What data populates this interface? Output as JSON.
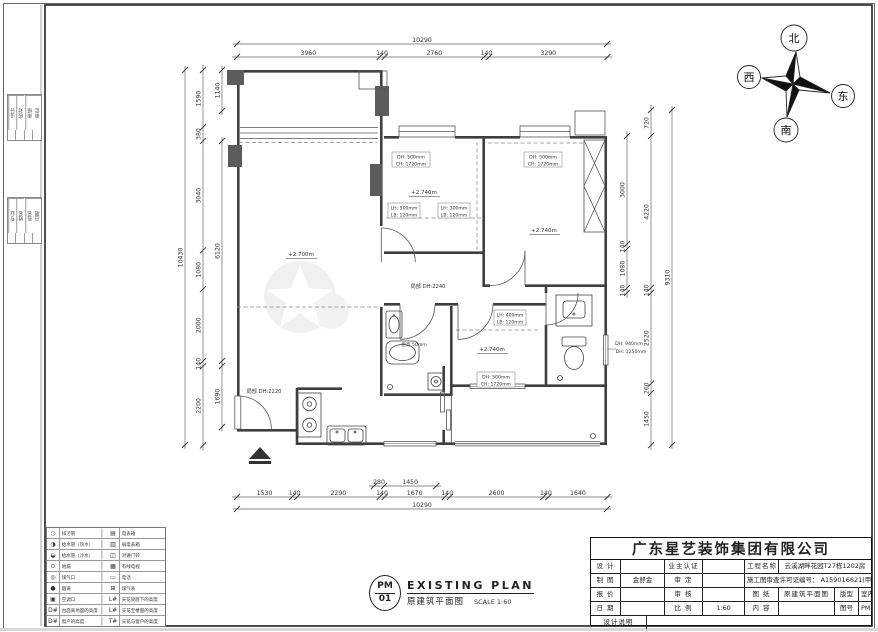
{
  "sheet": {
    "company": "广东星艺装饰集团有限公司",
    "title_en": "EXISTING PLAN",
    "title_cn": "原建筑平面图",
    "scale_label": "SCALE 1:60",
    "logo_top": "PM",
    "logo_bottom": "01"
  },
  "titleblock": {
    "design_label": "设 计",
    "draw_label": "制 图",
    "quote_label": "报 价",
    "date_label": "日 期",
    "note_label": "设计说明",
    "draw_value": "金舒金",
    "owner_label": "业主认证",
    "approve_label": "审 定",
    "check_label": "审 核",
    "ratio_label": "比 例",
    "ratio_value": "1:60",
    "project_label": "工程名称",
    "project_value": "云溪湖畔花园T27栋1202房",
    "permit_value": "施工图审查许可证编号： A159016621(甲级)",
    "paper_label": "图 纸",
    "content_label": "内 容",
    "paper_value": "原建筑平面图",
    "type_label": "版型",
    "type_value": "室内施工图",
    "no_label": "图号",
    "no_value": "PM-01"
  },
  "compass": {
    "north": "北",
    "south": "南",
    "east": "东",
    "west": "西"
  },
  "dims": {
    "top": {
      "total": "10290",
      "segs": [
        "3960",
        "140",
        "2760",
        "140",
        "3290"
      ]
    },
    "bottom": {
      "total": "10290",
      "segs": [
        "1530",
        "140",
        "2290",
        "140",
        "1670",
        "140",
        "2600",
        "140",
        "1640"
      ],
      "inner": [
        "280",
        "1450"
      ]
    },
    "left": {
      "total": "10430",
      "segs": [
        "1590",
        "380",
        "3040",
        "1080",
        "2000",
        "140",
        "2200"
      ],
      "inner": [
        "1140",
        "6120",
        "1690"
      ]
    },
    "right": {
      "total": "9310",
      "segs": [
        "720",
        "4220",
        "140",
        "2520",
        "260",
        "1450"
      ],
      "inner": [
        "3000",
        "140",
        "1080",
        "140"
      ]
    }
  },
  "plan": {
    "levels": {
      "living": "+2.700m",
      "bed2": "+2.740m",
      "bed3": "+2.740m",
      "bed4": "+2.740m"
    },
    "windows": {
      "dh500": "DH: 500mm",
      "ch1720": "CH: 1720mm",
      "dh940": "DH: 940mm",
      "dh1250": "DH: 1250mm"
    },
    "beams": {
      "lh500": "LH: 500mm",
      "lh300": "LH: 300mm",
      "lh400": "LH: 400mm",
      "lb120": "LB: 120mm"
    },
    "partial_2240": "局部 DH:2240",
    "partial_2220": "局部 DH:2220",
    "raise": "抬高:50mm"
  },
  "legend": {
    "rows": [
      {
        "li": "○",
        "ll": "排污管",
        "ri": "▤",
        "rl": "电表箱"
      },
      {
        "li": "◑",
        "ll": "给水管（热水）",
        "ri": "▥",
        "rl": "弱电表箱"
      },
      {
        "li": "◒",
        "ll": "给水管（冷水）",
        "ri": "◫",
        "rl": "对讲门铃"
      },
      {
        "li": "⊙",
        "ll": "地漏",
        "ri": "▦",
        "rl": "有线电视"
      },
      {
        "li": "◎",
        "ll": "煤气口",
        "ri": "▭",
        "rl": "电话"
      },
      {
        "li": "●",
        "ll": "烟道",
        "ri": "⊞",
        "rl": "煤气表"
      },
      {
        "li": "▣",
        "ll": "空调口",
        "ri": "L#",
        "rl": "天花梁底下的高度"
      },
      {
        "li": "D#",
        "ll": "台面离地面的高度",
        "ri": "L#",
        "rl": "天花至楼面的高度"
      },
      {
        "li": "D#",
        "ll": "窗户的高度",
        "ri": "T#",
        "rl": "天花与窗户的高度"
      }
    ]
  },
  "strip": {
    "top": [
      "设计",
      "校对",
      "审核",
      "审定"
    ],
    "bottom": [
      "专业",
      "姓名",
      "签名",
      "日期"
    ]
  }
}
